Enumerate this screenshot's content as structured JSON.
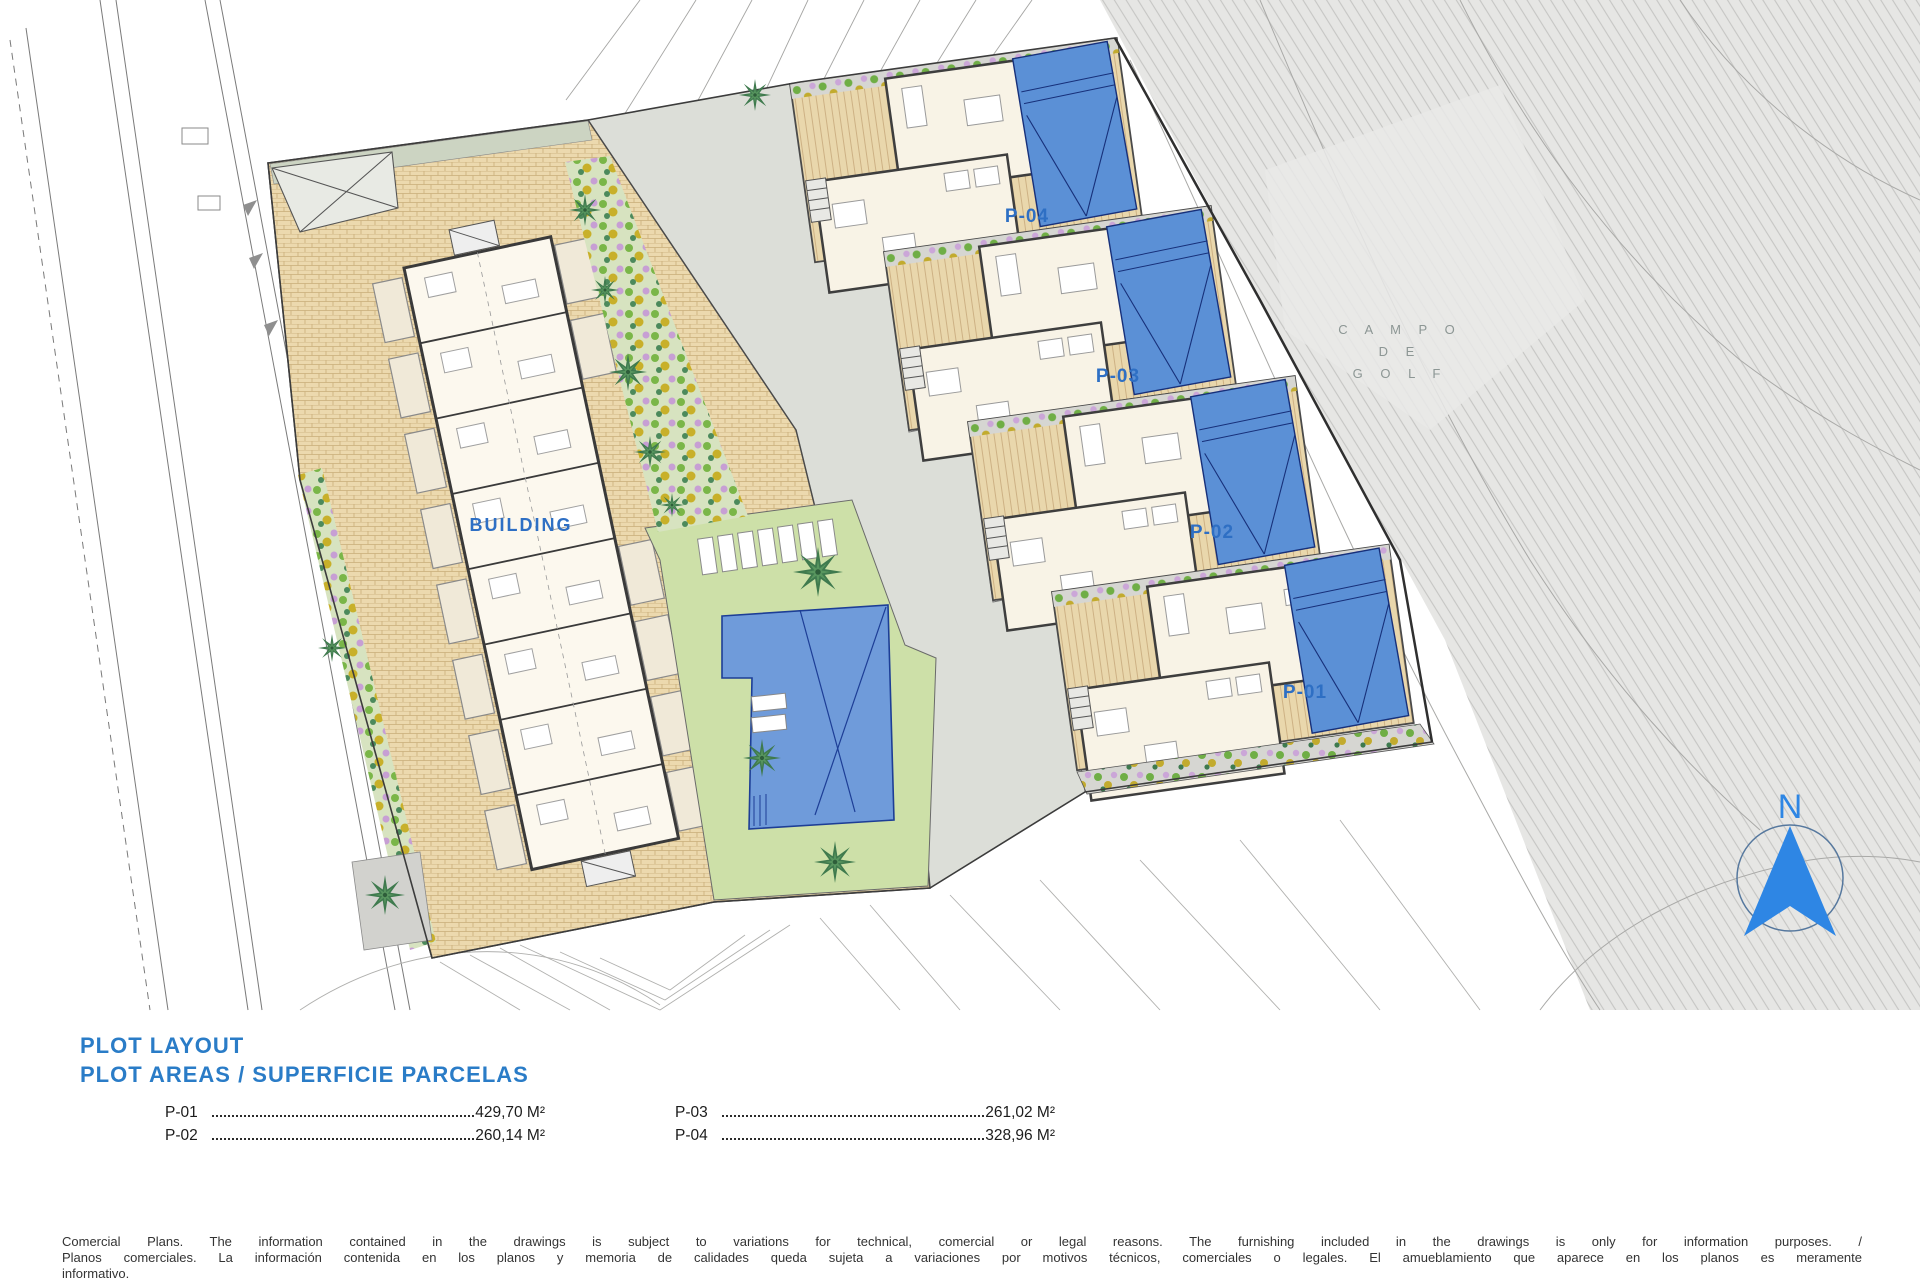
{
  "plan": {
    "labels": {
      "building": "BUILDING",
      "p01": "P-01",
      "p02": "P-02",
      "p03": "P-03",
      "p04": "P-04"
    },
    "golf": {
      "line1": "C A M P O",
      "line2": "D E",
      "line3": "G O L F"
    },
    "north": "N",
    "colors": {
      "label_blue": "#2e6fc4",
      "pool_blue": "#5b90d6",
      "terrace_tan": "#e9d7ac",
      "lawn_green": "#cde0a8",
      "golf_gray": "#e6e6e4"
    }
  },
  "legend": {
    "title1": "PLOT LAYOUT",
    "title2": "PLOT AREAS / SUPERFICIE PARCELAS",
    "areas": [
      {
        "plot": "P-01",
        "value": "429,70 M²"
      },
      {
        "plot": "P-02",
        "value": "260,14 M²"
      },
      {
        "plot": "P-03",
        "value": "261,02 M²"
      },
      {
        "plot": "P-04",
        "value": "328,96 M²"
      }
    ]
  },
  "disclaimer": {
    "line1": "Comercial Plans. The information contained in the drawings is subject to variations for technical, comercial or legal reasons. The furnishing included in the drawings is only for information purposes. /",
    "line2": "Planos comerciales. La información contenida en los planos y memoria de calidades queda sujeta a variaciones por motivos técnicos, comerciales o legales. El amueblamiento que aparece en los planos es meramente",
    "line3": "informativo."
  }
}
